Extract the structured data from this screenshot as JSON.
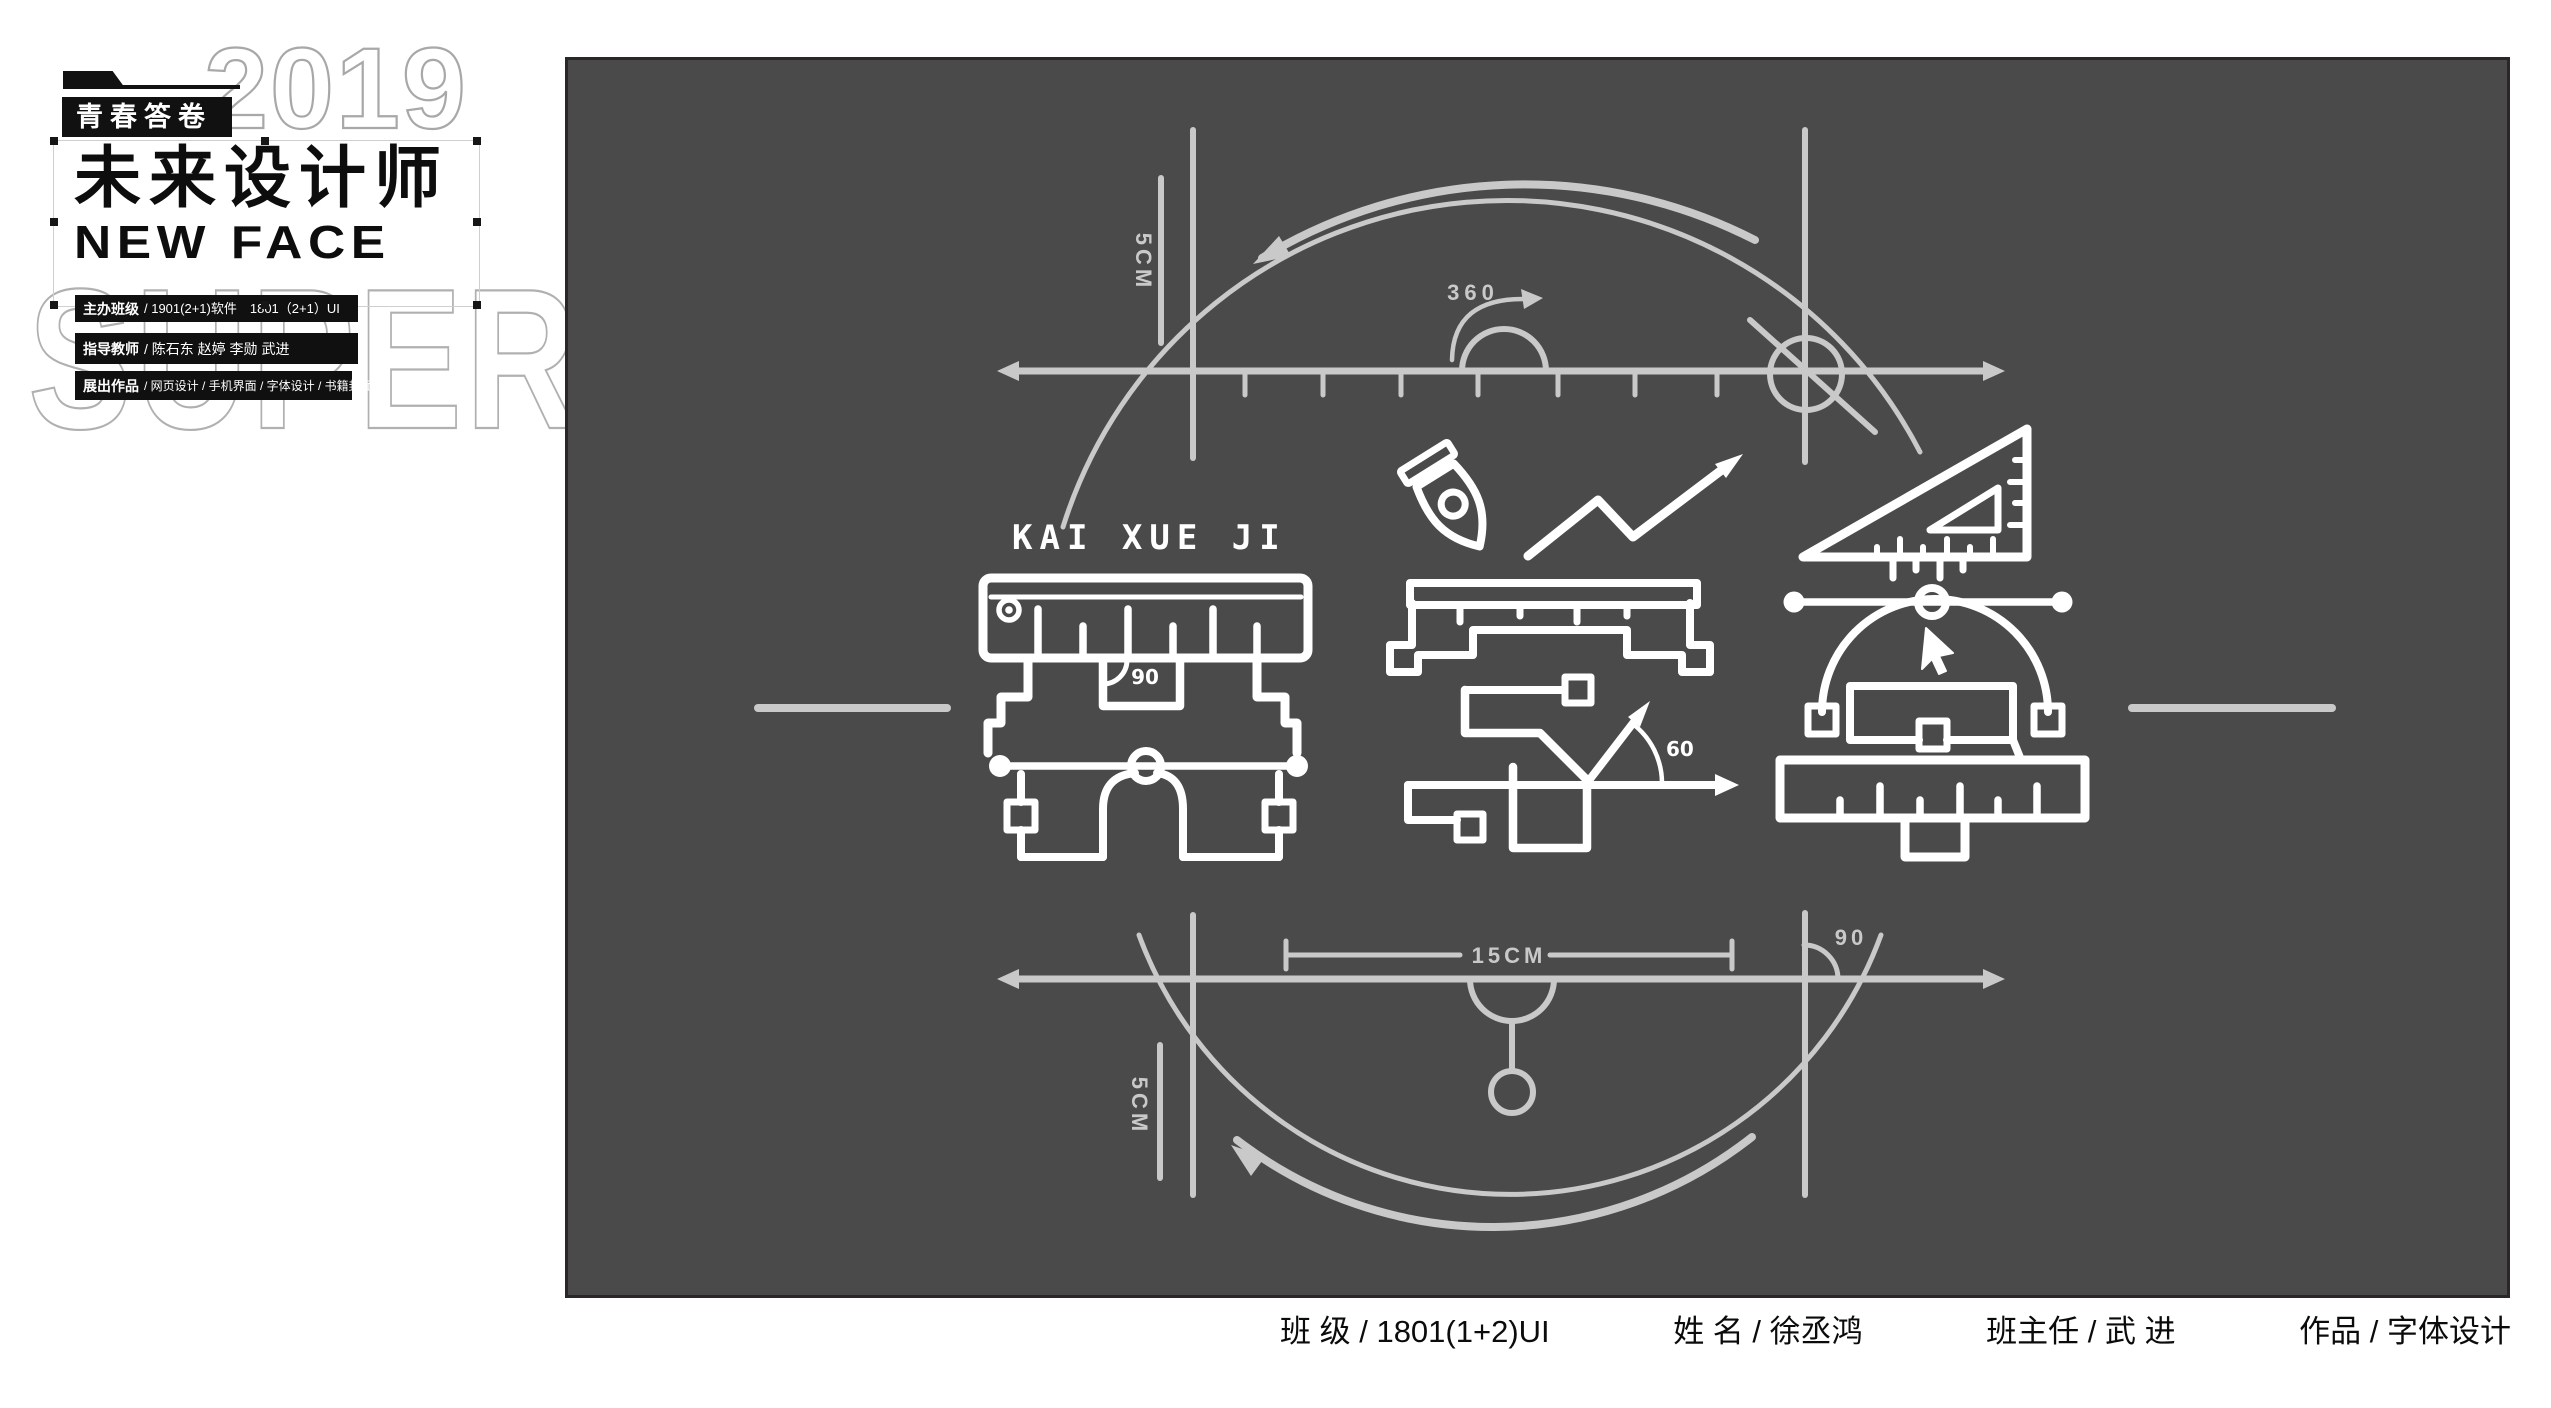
{
  "header": {
    "badge": "青春答卷",
    "title": "未来设计师",
    "subtitle": "NEW FACE",
    "watermark_year": "2019",
    "watermark_word": "SUPER",
    "info_rows": [
      {
        "label": "主办班级",
        "text": "/ 1901(2+1)软件　1801（2+1）UI"
      },
      {
        "label": "指导教师",
        "text": "/ 陈石东  赵婷  李勋  武进"
      },
      {
        "label": "展出作品",
        "text": "/ 网页设计 / 手机界面 / 字体设计 / 书籍封面"
      }
    ]
  },
  "canvas": {
    "pinyin_title": "KAI XUE JI",
    "labels": {
      "top_segment": "5CM",
      "rotation": "360",
      "kai_angle": "90",
      "xue_angle": "60",
      "width_dim": "15CM",
      "bottom_right_angle": "90",
      "bottom_segment": "5CM"
    },
    "colors": {
      "background": "#4a4a4a",
      "line": "#c9c9c9",
      "glyph": "#ffffff"
    }
  },
  "footer": {
    "items": [
      "班 级 / 1801(1+2)UI",
      "姓  名 / 徐丞鸿",
      "班主任 / 武 进",
      "作品 / 字体设计"
    ]
  }
}
